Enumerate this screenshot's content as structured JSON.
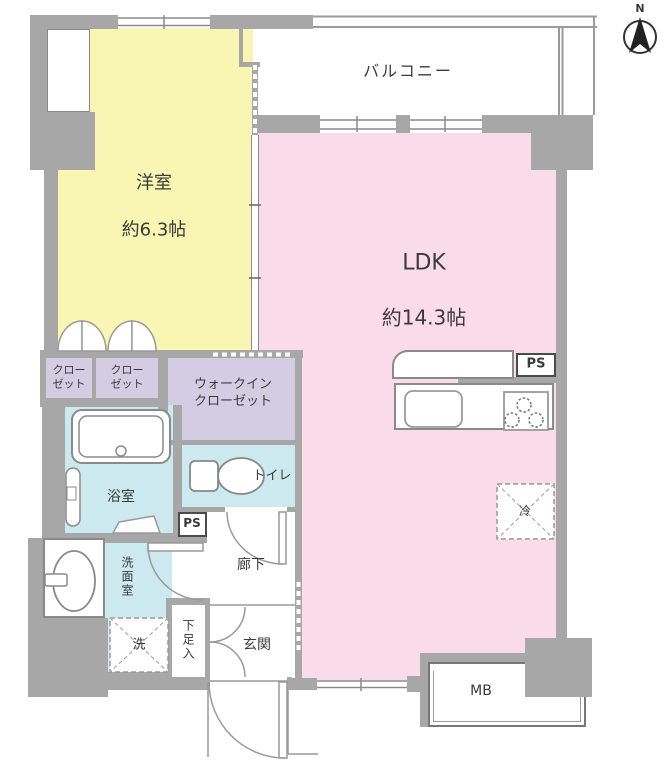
{
  "compass": {
    "north_label": "N"
  },
  "rooms": {
    "balcony": {
      "label": "バルコニー"
    },
    "western_room": {
      "label": "洋室",
      "size": "約6.3帖"
    },
    "ldk": {
      "label": "LDK",
      "size": "約14.3帖"
    },
    "closet_left": {
      "label": "クロー\nゼット"
    },
    "closet_right": {
      "label": "クロー\nゼット"
    },
    "walk_in_closet": {
      "label": "ウォークイン\nクローゼット"
    },
    "bathroom": {
      "label": "浴室"
    },
    "toilet": {
      "label": "トイレ"
    },
    "washroom": {
      "label": "洗面室"
    },
    "hallway": {
      "label": "廊下"
    },
    "entrance": {
      "label": "玄関"
    },
    "shoe_storage": {
      "label": "下足入"
    },
    "pipe_space_kitchen": {
      "label": "PS"
    },
    "pipe_space_hall": {
      "label": "PS"
    },
    "meter_box": {
      "label": "MB"
    },
    "refrigerator_space": {
      "label": "冷"
    },
    "washing_machine_space": {
      "label": "洗"
    }
  },
  "colors": {
    "wall": "#a7a7a7",
    "western_room": "#f8f6b2",
    "ldk": "#f9dce7",
    "closet": "#d3cde3",
    "wet_area": "#cbe9ef",
    "fixture_outline": "#8a8a8a",
    "text": "#3a3a3a"
  }
}
